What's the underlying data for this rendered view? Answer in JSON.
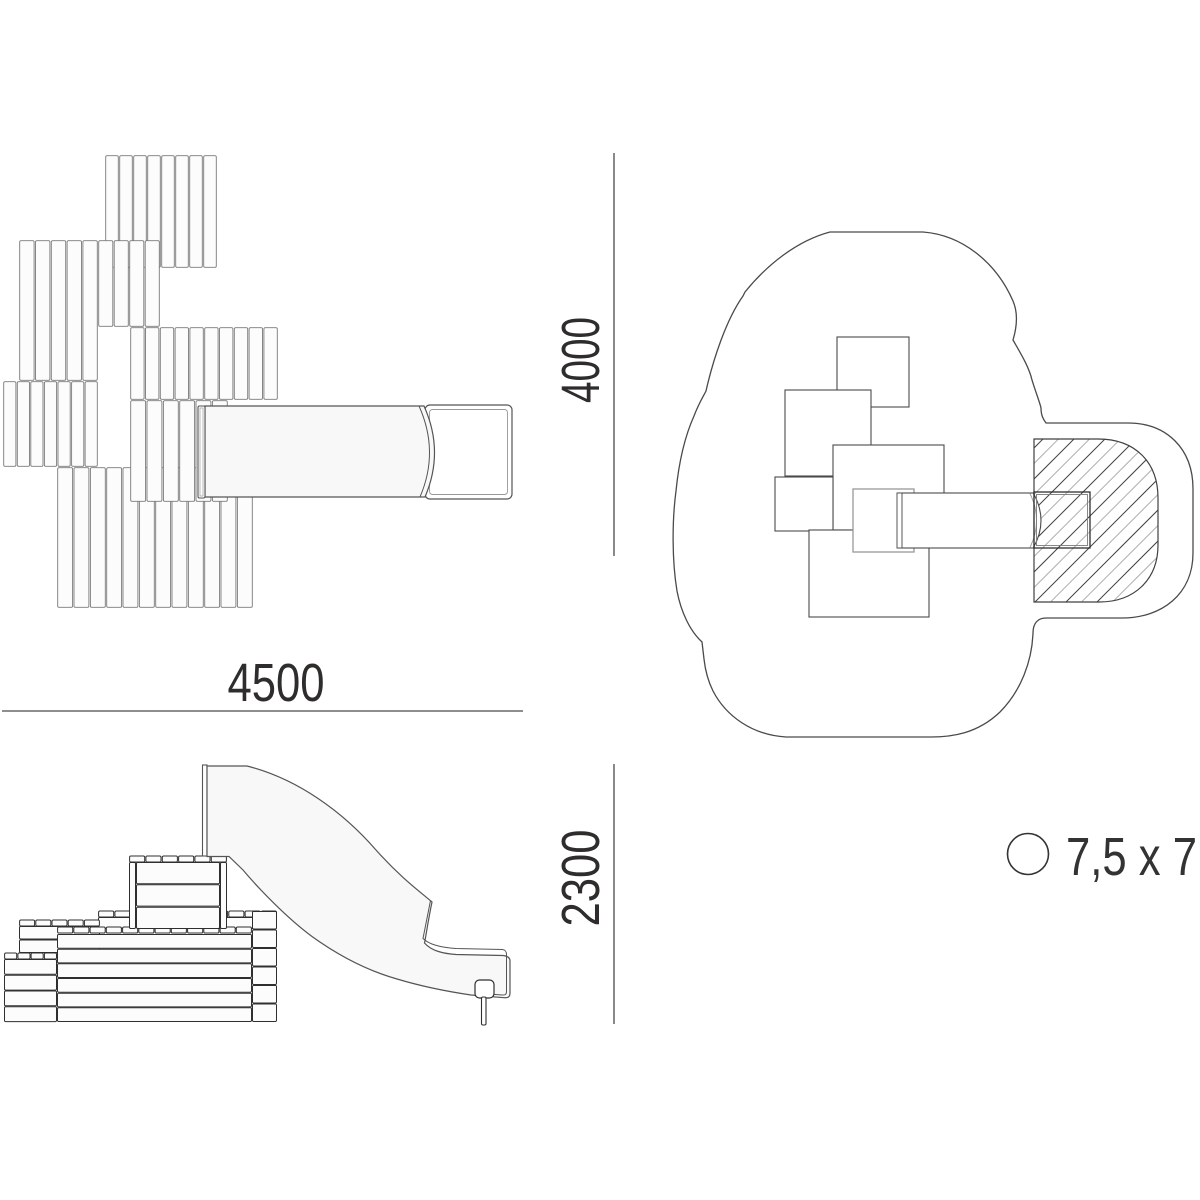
{
  "dimensions": {
    "width": "4500",
    "depth": "4000",
    "height": "2300"
  },
  "legend": {
    "label": "7,5 x 7"
  },
  "colors": {
    "text": "#2e2d2c",
    "dim_line": "#4a4a4a",
    "line_dark": "#2f2f2f",
    "line_mid": "#555555",
    "line_soft": "#7a7a7a",
    "line_light": "#999999",
    "hatch_dark": "#404040",
    "hatch_light": "#b0b0b0",
    "fill_white": "#ffffff",
    "fill_soft": "#f8f8f8",
    "fill_slat": "#fcfcfc"
  },
  "drawing": {
    "plan_view": {
      "slat_blocks": [
        [
          105,
          155,
          112,
          113,
          8
        ],
        [
          19,
          240,
          79,
          141,
          5
        ],
        [
          98,
          240,
          62,
          87,
          4
        ],
        [
          130,
          327,
          148,
          73,
          10
        ],
        [
          3,
          381,
          95,
          86,
          7
        ],
        [
          57,
          467,
          196,
          141,
          12
        ],
        [
          130,
          400,
          98,
          102,
          6
        ]
      ],
      "slide": {
        "plate": [
          198,
          406,
          7,
          92
        ],
        "body_path": "M 205,406 L 424,406 Q 444.5,451.5 425,497 L 205,497 Z",
        "inner_arc": "M 419,406 Q 439.5,451.5 420,497",
        "pad_outer": [
          425,
          405,
          87,
          94,
          5
        ],
        "pad_inner": [
          429.5,
          409.5,
          78,
          85,
          3
        ]
      }
    },
    "safety_view": {
      "outline_path": "M 830,232 L 923,232 C 962,235 996,262 1013,301 C 1019,315 1016,330 1013,340 C 1021,354 1029,367 1032,380 C 1036,393 1040,403 1041,408 C 1041,415 1043,419 1046,423 L 1128,423 C 1166,423 1193,448 1193,489 L 1193,553 C 1193,594 1162,618 1122,618 L 1046,618 C 1038,618 1033,623 1033,633 C 1032,661 1021,691 1000,712 C 977,734 951,737 931,737 L 786,737 C 752,735 726,716 713,691 C 707,679 705,668 704,659 L 702,642 C 690,631 681,612 677,591 C 672,561 672,521 676,491 C 679,461 685,436 694,416 C 699,403 703,397 706,391 C 713,360 726,320 743,296 L 745,292 C 766,266 796,241 830,232 Z",
      "hatch_region_path": "M 1034,439 L 1098,439 C 1136,439 1158,463 1158,498 L 1158,545 C 1158,579 1135,602 1099,602 L 1034,602 Z",
      "hatch": {
        "x_start": 870,
        "x_end": 1165,
        "step": 15.5,
        "y_low": 612,
        "y_high": 428,
        "run": 184
      },
      "squares_dark": [
        [
          837,
          337,
          72,
          70
        ],
        [
          785,
          390,
          86,
          86
        ],
        [
          833,
          445,
          111,
          85
        ],
        [
          775,
          477,
          58,
          54
        ],
        [
          809,
          530,
          120,
          87
        ]
      ],
      "square_light": [
        853,
        489,
        61,
        63
      ],
      "slide": {
        "body": [
          898,
          493,
          136,
          55
        ],
        "plate": [
          897,
          493,
          5,
          55
        ],
        "arc_fill": "M 1033.5,493.5 Q 1048.5,520.5 1033.5,547.5 L 1028,547.5 L 1028,493.5 Z",
        "arc_outer": "M 1033.5,493.5 Q 1048.5,520.5 1033.5,547.5",
        "arc_inner": "M 1030,493.5 Q 1043,520.5 1030,547.5",
        "pad_outer": [
          1034,
          492,
          56,
          56
        ],
        "pad_inner": [
          1036.5,
          494.5,
          51,
          51
        ]
      }
    },
    "elevation_view": {
      "pieces": [
        {
          "t": "cap",
          "x": 98,
          "y": 911,
          "w": 179,
          "n": 11
        },
        {
          "t": "boards",
          "x": 98,
          "y": 917,
          "w": 179,
          "h": 12,
          "rows": 1
        },
        {
          "t": "cap",
          "x": 19,
          "y": 920,
          "w": 81,
          "n": 5
        },
        {
          "t": "boards",
          "x": 19,
          "y": 926,
          "w": 81,
          "h": 27,
          "rows": 2
        },
        {
          "t": "cells",
          "x": 252,
          "y": 911,
          "w": 25,
          "h": 111,
          "rows": 6
        },
        {
          "t": "cap",
          "x": 57,
          "y": 927,
          "w": 195,
          "n": 12
        },
        {
          "t": "boards",
          "x": 57,
          "y": 934,
          "w": 195,
          "h": 88,
          "rows": 6
        },
        {
          "t": "cap",
          "x": 4,
          "y": 953,
          "w": 53,
          "n": 4
        },
        {
          "t": "boards",
          "x": 4,
          "y": 959,
          "w": 53,
          "h": 63,
          "rows": 4
        },
        {
          "t": "cap",
          "x": 129,
          "y": 856,
          "w": 98,
          "n": 6
        },
        {
          "t": "boards",
          "x": 136,
          "y": 862,
          "w": 84,
          "h": 67,
          "rows": 3
        },
        {
          "t": "boards",
          "x": 129,
          "y": 862,
          "w": 7,
          "h": 67,
          "rows": 1
        },
        {
          "t": "boards",
          "x": 220,
          "y": 862,
          "w": 7,
          "h": 67,
          "rows": 1
        }
      ],
      "slide": {
        "plate": [
          202.5,
          765,
          4.5,
          91
        ],
        "body_path": "M 207,766 L 247,766 C 298,779 343,812 376,850 C 399,876 419,891 432,902 C 428,921 426,936 424.5,943 C 431.5,951 443,953.5 456,954.5 L 503,955.5 C 508,956 510,958 510,961 L 510,993 C 510,997 508,998 504,997.7 L 471,995 C 444,991 417,985 397,979 C 367,970.5 337,954.5 312,936.5 C 287,918 259,889 243,870 L 229,856.5 L 207,856.5 Z",
        "ridge_path": "M 430.5,900.5 C 427,918 424.5,931 423,938.5 C 429,944.5 441,947.5 456,948.5 L 502.5,949.5 C 505.5,950 506.5,951.5 506.5,954.5 L 506.5,991.5 C 506.5,994.5 505,995.3 502,995 L 486,993.7",
        "foot": [
          475,
          980,
          19,
          18,
          4.5
        ],
        "leg": [
          481.5,
          997,
          4.5,
          28
        ]
      }
    },
    "dim_lines": {
      "width_line": [
        2,
        711,
        523,
        711
      ],
      "depth_line": [
        614,
        153,
        614,
        556
      ],
      "height_line": [
        614,
        764,
        614,
        1024
      ]
    },
    "legend_circle": {
      "cx": 1028,
      "cy": 854,
      "r": 20.5
    }
  }
}
